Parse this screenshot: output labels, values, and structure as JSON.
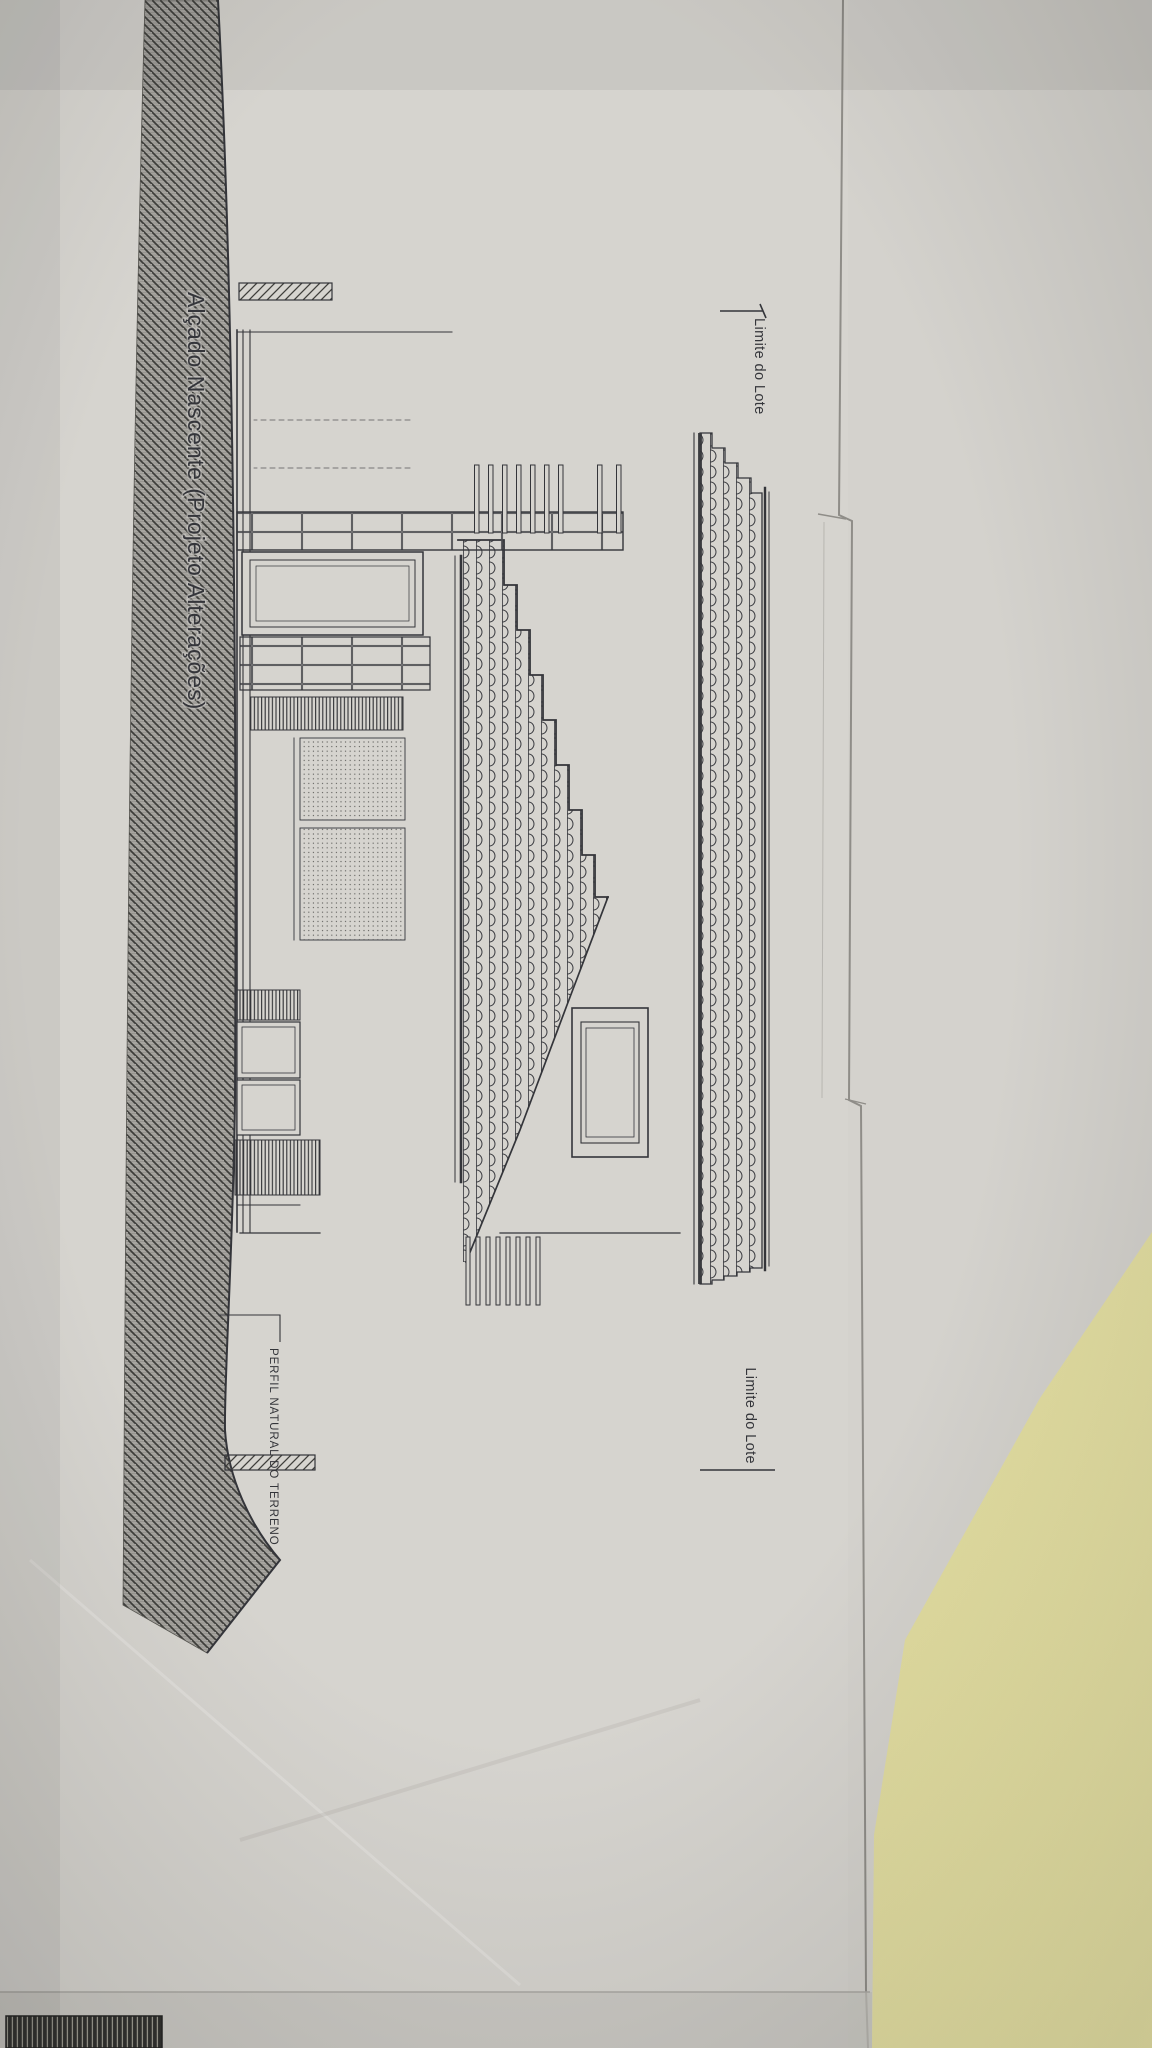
{
  "drawing": {
    "title": "Alçado Nascente (Projeto Alterações)",
    "annotations": {
      "lot_boundary_left": "Limite do Lote",
      "lot_boundary_right": "Limite do Lote",
      "terrain_profile": "PERFIL NATURAL DO TERRENO"
    },
    "colors": {
      "paper": "#d6d4cf",
      "paper_under": "#d1cfca",
      "ink": "#34353a",
      "ground_hatch": "#a7a5a0",
      "yellow_paper": "#e7e2a3",
      "dark_object": "#2f2f2d"
    }
  }
}
